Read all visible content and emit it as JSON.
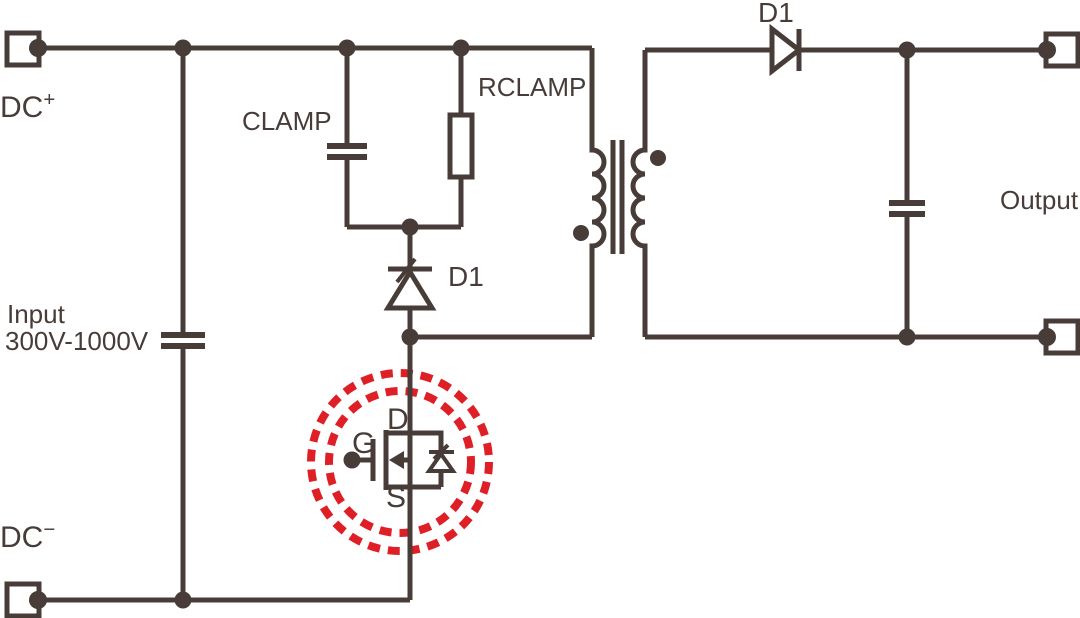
{
  "colors": {
    "wire": "#473C38",
    "highlight": "#DF1F26",
    "background": "#FFFFFF"
  },
  "input_section": {
    "dc_positive": "DC",
    "dc_positive_sign": "+",
    "dc_negative": "DC",
    "dc_negative_sign": "−",
    "input_label": "Input",
    "input_range": "300V-1000V"
  },
  "clamp_section": {
    "capacitor_label": "CLAMP",
    "resistor_label": "RCLAMP",
    "diode_label": "D1"
  },
  "mosfet": {
    "drain_label": "D",
    "gate_label": "G",
    "source_label": "S"
  },
  "output_section": {
    "diode_label": "D1",
    "output_label": "Output"
  }
}
